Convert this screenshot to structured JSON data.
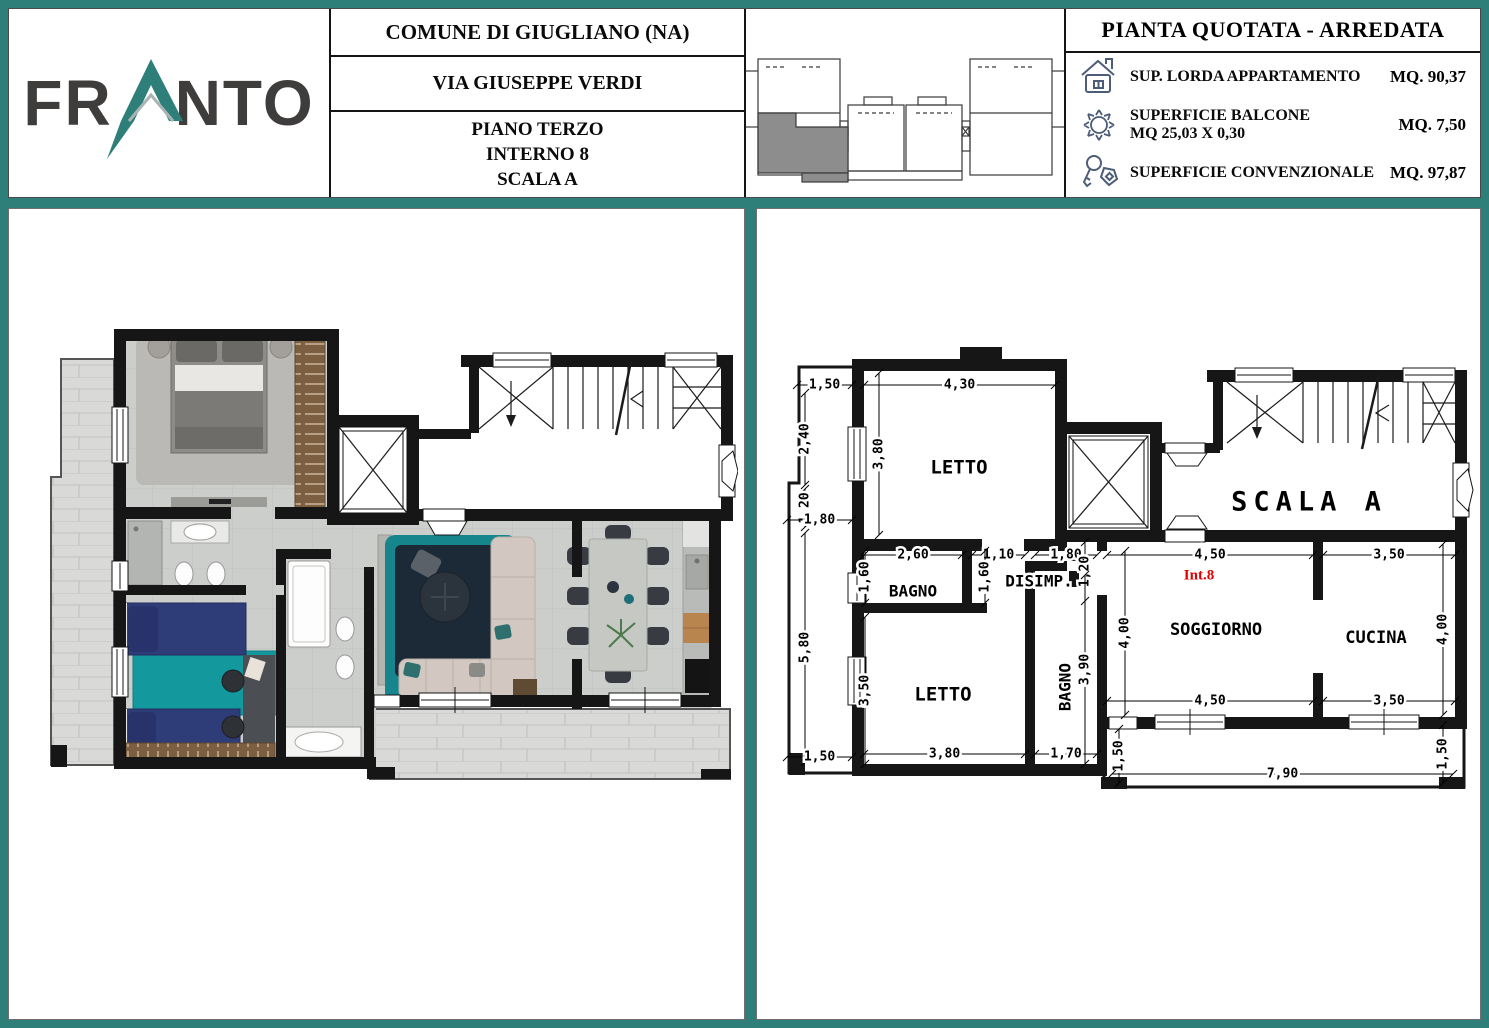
{
  "window": {
    "width": 1489,
    "height": 1028,
    "border_color": "#2e7f7a"
  },
  "header": {
    "logo": {
      "text_left": "FR",
      "text_right": "NTO",
      "full_name": "FRANTO",
      "accent_color": "#2e7f7a",
      "text_color": "#3f3c3c"
    },
    "address": {
      "municipality": "COMUNE DI GIUGLIANO (NA)",
      "street": "VIA GIUSEPPE VERDI",
      "floor": "PIANO TERZO",
      "unit": "INTERNO 8",
      "staircase": "SCALA A"
    },
    "site_thumbnail": {
      "highlight_color": "#8d8d8d",
      "description": "building-key-plan-with-highlighted-unit"
    },
    "metrics": {
      "title": "PIANTA QUOTATA - ARREDATA",
      "icon_color": "#4d5d78",
      "rows": [
        {
          "icon": "house-icon",
          "label": "SUP. LORDA APPARTAMENTO",
          "sublabel": "",
          "value": "MQ. 90,37"
        },
        {
          "icon": "sun-icon",
          "label": "SUPERFICIE BALCONE",
          "sublabel": "MQ 25,03 X 0,30",
          "value": "MQ. 7,50"
        },
        {
          "icon": "keys-icon",
          "label": "SUPERFICIE CONVENZIONALE",
          "sublabel": "",
          "value": "MQ. 97,87"
        }
      ]
    }
  },
  "technical_plan": {
    "unit_label_color": "#e10000",
    "rooms": [
      {
        "id": "letto-top",
        "text": "LETTO"
      },
      {
        "id": "bagno-1",
        "text": "BAGNO"
      },
      {
        "id": "disimp",
        "text": "DISIMP."
      },
      {
        "id": "letto-2",
        "text": "LETTO"
      },
      {
        "id": "bagno-2",
        "text": "BAGNO"
      },
      {
        "id": "soggiorno",
        "text": "SOGGIORNO"
      },
      {
        "id": "cucina",
        "text": "CUCINA"
      },
      {
        "id": "scala-a",
        "text": "SCALA A"
      },
      {
        "id": "int-8",
        "text": "Int.8"
      }
    ],
    "dimensions": [
      "1,50",
      "4,30",
      "2,40",
      "3,80",
      "1,20",
      "1,80",
      "5,80",
      "1,50",
      "2,60",
      "1,10",
      "1,80",
      "1,60",
      "1,60",
      "1,20",
      "4,50",
      "3,50",
      "3,50",
      "3,90",
      "4,00",
      "4,00",
      "4,50",
      "3,50",
      "3,80",
      "1,70",
      "1,50",
      "7,90",
      "1,50"
    ]
  }
}
